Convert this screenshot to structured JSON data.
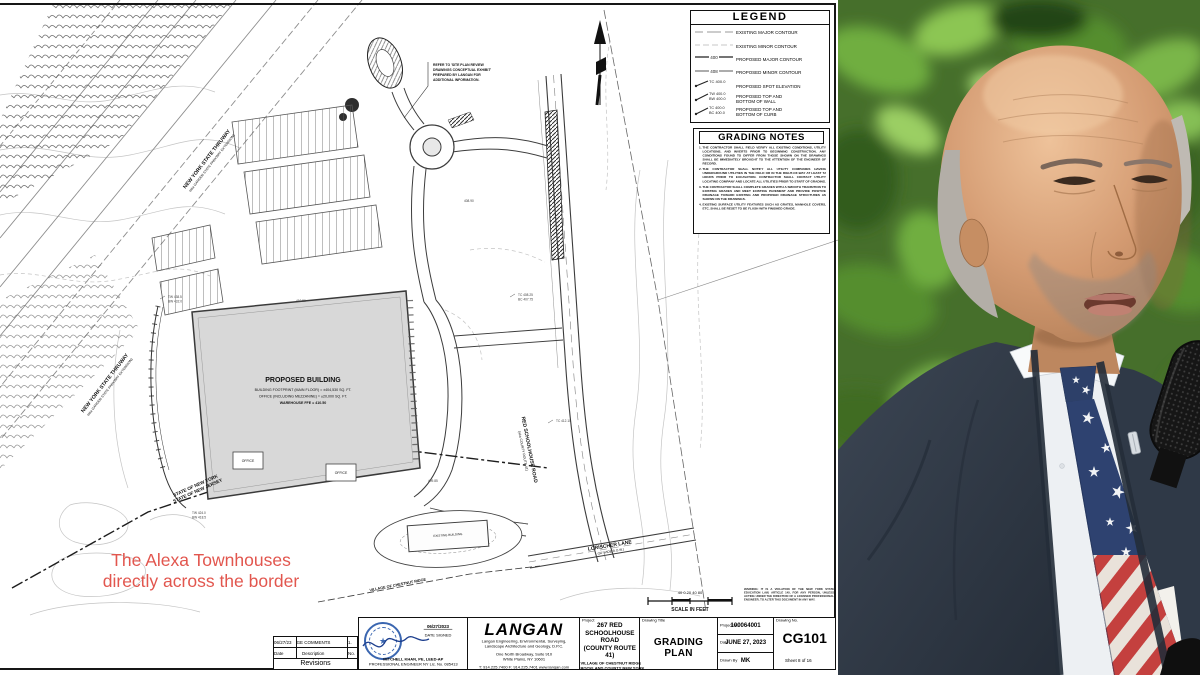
{
  "plan": {
    "legend": {
      "title": "LEGEND",
      "items": [
        {
          "label": "EXISTING MAJOR CONTOUR"
        },
        {
          "label": "EXISTING MINOR CONTOUR"
        },
        {
          "label": "PROPOSED MAJOR CONTOUR",
          "sym": "400"
        },
        {
          "label": "PROPOSED MINOR CONTOUR",
          "sym": "408"
        },
        {
          "label": "PROPOSED SPOT ELEVATION",
          "sym": "TC 400.0"
        },
        {
          "label": "PROPOSED TOP AND",
          "label2": "BOTTOM OF WALL",
          "sym": "TW 400.0",
          "sym2": "BW 400.0"
        },
        {
          "label": "PROPOSED TOP AND",
          "label2": "BOTTOM OF CURB",
          "sym": "TC 400.0",
          "sym2": "BC 400.0"
        }
      ]
    },
    "grading_notes": {
      "title": "GRADING NOTES",
      "notes": [
        "THE CONTRACTOR SHALL FIELD VERIFY ALL EXISTING CONDITIONS, UTILITY LOCATIONS, AND INVERTS PRIOR TO BEGINNING CONSTRUCTION. ANY CONDITIONS FOUND TO DIFFER FROM THOSE SHOWN ON THE DRAWINGS SHALL BE IMMEDIATELY BROUGHT TO THE ATTENTION OF THE ENGINEER OF RECORD.",
        "THE CONTRACTOR SHALL NOTIFY ALL UTILITY COMPANIES HAVING UNDERGROUND UTILITIES IN THE FIELD OR IN THE RIGHT-OF-WAY AT LEAST 72 HOURS PRIOR TO EXCAVATION. CONTRACTOR SHALL CONTACT UTILITY LOCATING COMPANY AND LOCATE ALL UTILITIES PRIOR TO START OF GRADING.",
        "THE CONTRACTOR SHALL COMPLETE GRADES WITH A SMOOTH TRANSITION TO EXISTING GRADES AND MEET EXISTING PAVEMENT AND PROVIDE POSITIVE DRAINAGE TOWARD EXISTING AND PROPOSED DRAINAGE STRUCTURES AS SHOWN ON THE DRAWINGS.",
        "EXISTING SURFACE UTILITY FEATURES SUCH AS GRATES, MANHOLE COVERS, ETC. SHALL BE RESET TO BE FLUSH WITH FINISHED GRADE."
      ]
    },
    "note_box_lines": [
      "REFER TO 'SITE PLAN REVIEW",
      "DRAWINGS CONCEPTUAL EXHIBIT'",
      "PREPARED BY LANGAN FOR",
      "ADDITIONAL INFORMATION."
    ],
    "labels": {
      "thruway1": "NEW YORK STATE THRUWAY",
      "thruway2": "(aka GARDEN STATE PARKWAY EXTENSION)",
      "red_road1": "RED SCHOOLHOUSE ROAD",
      "red_road2": "(aka COUNTY ROUTE 41)",
      "lorischer1": "LORISCHER LANE",
      "lorischer2": "(50' WIDE R.O.W.)",
      "state1": "STATE OF NEW YORK",
      "state2": "STATE OF NEW JERSEY",
      "village": "VILLAGE OF CHESTNUT RIDGE",
      "existing_building": "EXISTING BUILDING",
      "building_title": "PROPOSED BUILDING",
      "building_l1": "BUILDING FOOTPRINT (MAIN FLOOR) = ±404,530 SQ. FT.",
      "building_l2": "OFFICE (INCLUDING MEZZANINE) = ±20,000 SQ. FT.",
      "building_l3": "WAREHOUSE FFE = 410.50",
      "office": "OFFICE"
    },
    "spots": [
      "TW 438.5",
      "BW 432.0",
      "TC 408.25",
      "BC 407.75",
      "410.50",
      "409.85",
      "TW 424.0",
      "BW 418.5",
      "TC 412.10",
      "408.90"
    ],
    "annotation": {
      "line1": "The Alexa Townhouses",
      "line2": "directly across the border",
      "color": "#e2564e"
    },
    "scale": {
      "numbers": "40   0   20   40           80",
      "label": "SCALE IN FEET"
    },
    "warning": "WARNING: IT IS A VIOLATION OF THE NEW YORK STATE EDUCATION LAW, ARTICLE 145, FOR ANY PERSON, UNLESS ACTING UNDER THE DIRECTION OF A LICENSED PROFESSIONAL ENGINEER, TO ALTER THIS DOCUMENT IN ANY WAY.",
    "footer_meta": "Date: 6/27/2023   User: mk   Style Table: Langan.stb   Layout: CG101   Project No. 100064001"
  },
  "titleblock": {
    "revisions": {
      "row": {
        "date": "06/27/23",
        "desc": "REVISED PER VILLAGE COMMENTS",
        "no": "1."
      },
      "date_label": "Date",
      "desc_label": "Description",
      "no_label": "No.",
      "title": "Revisions"
    },
    "seal": {
      "star": "★",
      "date": "06/27/2023",
      "date_label": "DATE SIGNED",
      "name": "MITCHELL KHAN, PE, LEED-AP",
      "license": "PROFESSIONAL ENGINEER NY Lic. No. 085413"
    },
    "firm": {
      "name": "LANGAN",
      "desc1": "Langan Engineering, Environmental, Surveying,",
      "desc2": "Landscape Architecture and Geology, D.P.C.",
      "addr1": "One North Broadway, Suite 910",
      "addr2": "White Plains, NY 10601",
      "phone": "T: 914.225.7400   F: 914.225.7401   www.langan.com"
    },
    "project": {
      "label": "Project",
      "name1": "267 RED",
      "name2": "SCHOOLHOUSE ROAD",
      "name3": "(COUNTY ROUTE 41)",
      "muni": "VILLAGE OF CHESTNUT RIDGE",
      "county": "ROCKLAND COUNTY                NEW YORK"
    },
    "drawing": {
      "label": "Drawing Title",
      "title": "GRADING PLAN"
    },
    "meta": {
      "project_no_label": "Project No.",
      "project_no": "100064001",
      "date_label": "Date",
      "date": "JUNE 27, 2023",
      "drawn_label": "Drawn By",
      "drawn": "MK",
      "checked_label": "Checked By",
      "checked": "CE"
    },
    "number": {
      "label": "Drawing No.",
      "value": "CG101",
      "sheet": "Sheet 8 of 16"
    }
  }
}
